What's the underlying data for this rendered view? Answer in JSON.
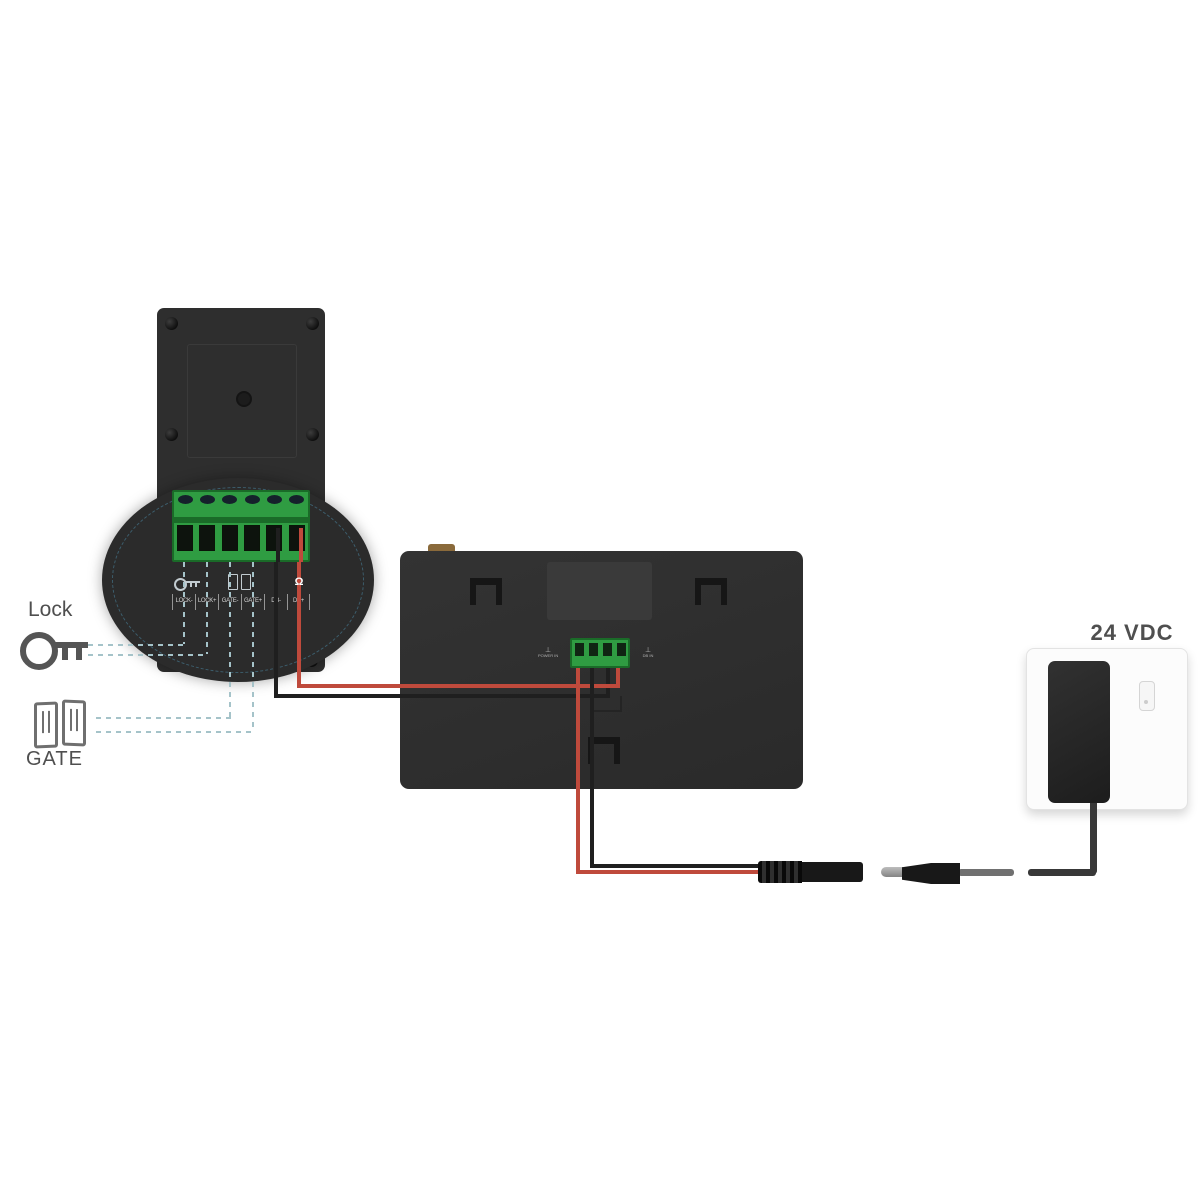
{
  "labels": {
    "lock": "Lock",
    "gate": "GATE",
    "power_rating": "24 VDC"
  },
  "door_station": {
    "terminals": [
      "LOCK-",
      "LOCK+",
      "GATE-",
      "GATE+",
      "DB-",
      "DB+"
    ]
  },
  "indoor_unit": {
    "port_left": "POWER IN",
    "port_right": "DB IN"
  },
  "icons": {
    "bell_glyph": "Ω",
    "ground_glyph": "⊥"
  },
  "colors": {
    "wire_red": "#bf4a3c",
    "wire_black": "#1f1f1f",
    "terminal_green": "#2f9c42",
    "terminal_green_dark": "#1a6b28",
    "dash": "#a5c3c9",
    "tab_orange": "#8a6a3b"
  }
}
